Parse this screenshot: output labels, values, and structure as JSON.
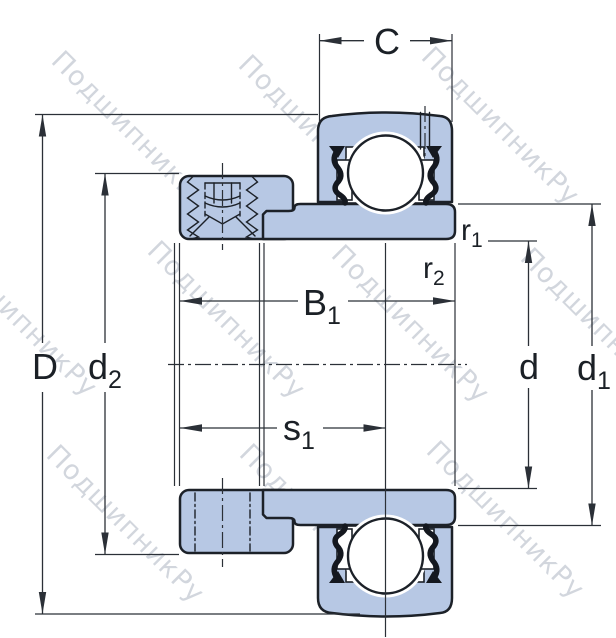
{
  "watermark": {
    "text": "ПодшипникРу"
  },
  "dimensions": {
    "C": {
      "label": "C"
    },
    "D": {
      "label": "D"
    },
    "d2": {
      "main": "d",
      "sub": "2"
    },
    "B1": {
      "main": "B",
      "sub": "1"
    },
    "s1": {
      "main": "s",
      "sub": "1"
    },
    "d": {
      "label": "d"
    },
    "d1": {
      "main": "d",
      "sub": "1"
    },
    "r1": {
      "main": "r",
      "sub": "1"
    },
    "r2": {
      "main": "r",
      "sub": "2"
    }
  },
  "colors": {
    "part_fill": "#b7c8e4",
    "outline": "#1c2128",
    "dimension_lines": "#2b3037",
    "label_text": "#1b2026",
    "watermark": "#aeb6c3",
    "background": "#ffffff"
  }
}
